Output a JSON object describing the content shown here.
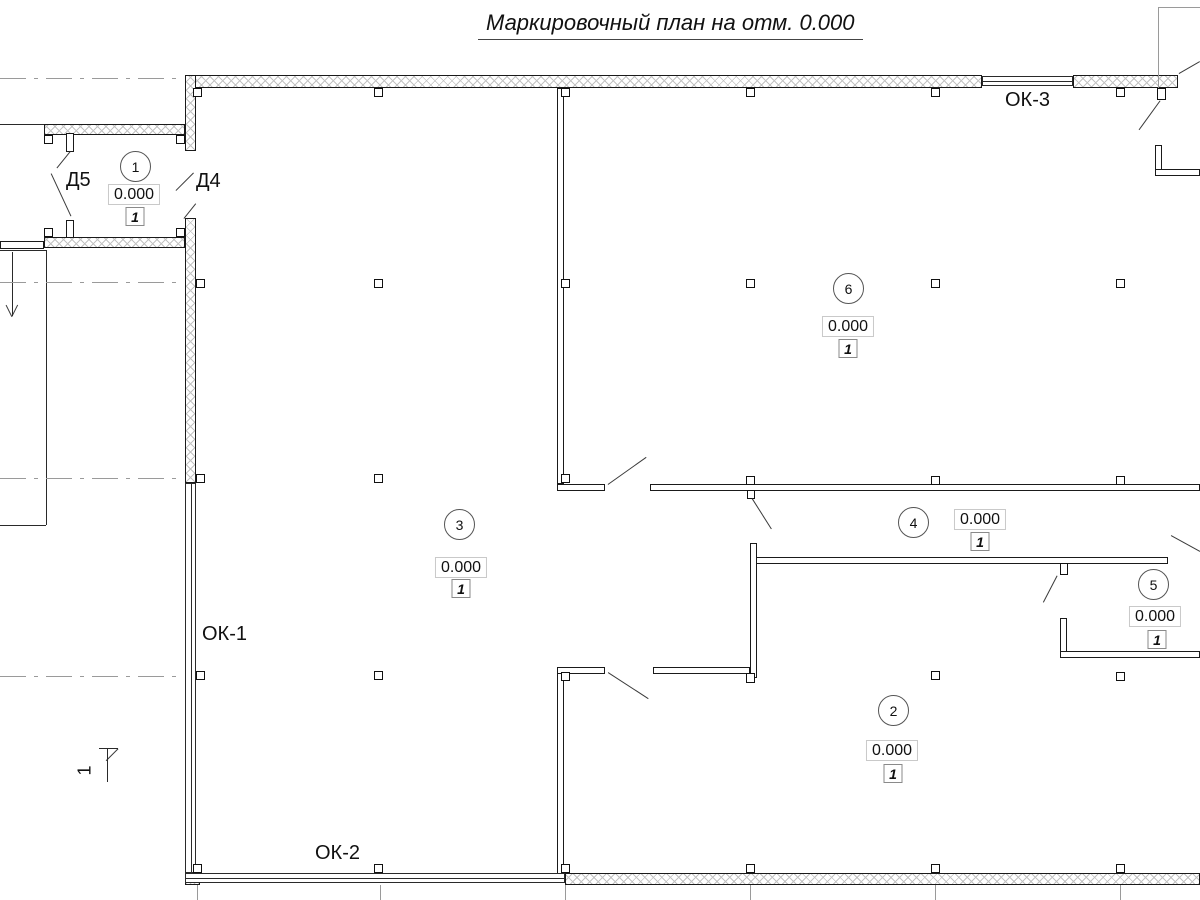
{
  "title": "Маркировочный план на отм. 0.000",
  "labels": {
    "doors": [
      {
        "name": "door-label-d5",
        "text": "Д5",
        "x": 66,
        "y": 169
      },
      {
        "name": "door-label-d4",
        "text": "Д4",
        "x": 196,
        "y": 170
      }
    ],
    "windows": [
      {
        "name": "window-label-ok1",
        "text": "ОК-1",
        "x": 202,
        "y": 623
      },
      {
        "name": "window-label-ok2",
        "text": "ОК-2",
        "x": 315,
        "y": 842
      },
      {
        "name": "window-label-ok3",
        "text": "ОК-3",
        "x": 1005,
        "y": 89
      }
    ],
    "section_mark": {
      "text": "1",
      "x": 80,
      "y": 760
    }
  },
  "rooms": [
    {
      "number": "1",
      "elevation": "0.000",
      "finish": "1",
      "circle": {
        "cx": 135,
        "cy": 166
      },
      "elev_box": {
        "cx": 134,
        "cy": 194
      },
      "finish_box": {
        "cx": 135,
        "cy": 217
      }
    },
    {
      "number": "6",
      "elevation": "0.000",
      "finish": "1",
      "circle": {
        "cx": 848,
        "cy": 288
      },
      "elev_box": {
        "cx": 848,
        "cy": 326
      },
      "finish_box": {
        "cx": 848,
        "cy": 349
      }
    },
    {
      "number": "3",
      "elevation": "0.000",
      "finish": "1",
      "circle": {
        "cx": 459,
        "cy": 524
      },
      "elev_box": {
        "cx": 461,
        "cy": 567
      },
      "finish_box": {
        "cx": 461,
        "cy": 589
      }
    },
    {
      "number": "4",
      "elevation": "0.000",
      "finish": "1",
      "circle": {
        "cx": 913,
        "cy": 522
      },
      "elev_box": {
        "cx": 980,
        "cy": 519
      },
      "finish_box": {
        "cx": 980,
        "cy": 542
      }
    },
    {
      "number": "5",
      "elevation": "0.000",
      "finish": "1",
      "circle": {
        "cx": 1153,
        "cy": 584
      },
      "elev_box": {
        "cx": 1155,
        "cy": 616
      },
      "finish_box": {
        "cx": 1157,
        "cy": 640
      }
    },
    {
      "number": "2",
      "elevation": "0.000",
      "finish": "1",
      "circle": {
        "cx": 893,
        "cy": 710
      },
      "elev_box": {
        "cx": 892,
        "cy": 750
      },
      "finish_box": {
        "cx": 893,
        "cy": 774
      }
    }
  ],
  "geometry": {
    "hatched_walls": [
      {
        "name": "exterior-wall-top-left",
        "x": 185,
        "y": 75,
        "w": 797,
        "h": 13
      },
      {
        "name": "exterior-wall-top-right",
        "x": 1073,
        "y": 75,
        "w": 105,
        "h": 13
      },
      {
        "name": "exterior-wall-left-upper",
        "x": 185,
        "y": 75,
        "w": 11,
        "h": 76
      },
      {
        "name": "exterior-wall-left-mid",
        "x": 185,
        "y": 218,
        "w": 11,
        "h": 265
      },
      {
        "name": "vestibule-wall-top",
        "x": 44,
        "y": 124,
        "w": 141,
        "h": 11
      },
      {
        "name": "vestibule-wall-bottom",
        "x": 44,
        "y": 237,
        "w": 141,
        "h": 11
      },
      {
        "name": "exterior-wall-bottom",
        "x": 565,
        "y": 873,
        "w": 635,
        "h": 12
      },
      {
        "name": "corner-block-bottom-left",
        "x": 185,
        "y": 871,
        "w": 15,
        "h": 14
      }
    ],
    "thin_walls": [
      {
        "name": "interior-wall-a",
        "x": 557,
        "y": 88,
        "w": 7,
        "h": 396
      },
      {
        "name": "interior-wall-a-return",
        "x": 557,
        "y": 484,
        "w": 48,
        "h": 7
      },
      {
        "name": "interior-wall-b",
        "x": 650,
        "y": 484,
        "w": 550,
        "h": 7
      },
      {
        "name": "interior-wall-c",
        "x": 756,
        "y": 557,
        "w": 412,
        "h": 7
      },
      {
        "name": "interior-wall-d",
        "x": 750,
        "y": 543,
        "w": 7,
        "h": 135
      },
      {
        "name": "interior-wall-e",
        "x": 653,
        "y": 667,
        "w": 97,
        "h": 7
      },
      {
        "name": "interior-wall-f",
        "x": 557,
        "y": 667,
        "w": 7,
        "h": 209
      },
      {
        "name": "interior-wall-f-return",
        "x": 557,
        "y": 667,
        "w": 48,
        "h": 7
      },
      {
        "name": "interior-wall-g-vertical",
        "x": 1060,
        "y": 618,
        "w": 7,
        "h": 40
      },
      {
        "name": "interior-wall-g-horizontal",
        "x": 1060,
        "y": 651,
        "w": 140,
        "h": 7
      },
      {
        "name": "interior-wall-h-vertical",
        "x": 1155,
        "y": 145,
        "w": 7,
        "h": 31
      },
      {
        "name": "interior-wall-h-horizontal",
        "x": 1155,
        "y": 169,
        "w": 45,
        "h": 7
      },
      {
        "name": "wall-stub-left-bottom",
        "x": 0,
        "y": 241,
        "w": 44,
        "h": 8
      },
      {
        "name": "door-leaf-d5-upper",
        "x": 66,
        "y": 133,
        "w": 8,
        "h": 19
      },
      {
        "name": "door-leaf-d5-lower",
        "x": 66,
        "y": 220,
        "w": 8,
        "h": 18
      }
    ],
    "windows": [
      {
        "name": "window-ok1",
        "x": 185,
        "y": 483,
        "w": 11,
        "h": 390,
        "dir": "v"
      },
      {
        "name": "window-ok2",
        "x": 185,
        "y": 873,
        "w": 380,
        "h": 10,
        "dir": "h"
      },
      {
        "name": "window-ok3",
        "x": 982,
        "y": 76,
        "w": 91,
        "h": 10,
        "dir": "h"
      }
    ],
    "columns": [
      {
        "x": 193,
        "y": 88
      },
      {
        "x": 374,
        "y": 88
      },
      {
        "x": 561,
        "y": 88
      },
      {
        "x": 746,
        "y": 88
      },
      {
        "x": 931,
        "y": 88
      },
      {
        "x": 1116,
        "y": 88
      },
      {
        "x": 196,
        "y": 279
      },
      {
        "x": 374,
        "y": 279
      },
      {
        "x": 561,
        "y": 279
      },
      {
        "x": 746,
        "y": 279
      },
      {
        "x": 931,
        "y": 279
      },
      {
        "x": 1116,
        "y": 279
      },
      {
        "x": 196,
        "y": 474
      },
      {
        "x": 374,
        "y": 474
      },
      {
        "x": 561,
        "y": 474
      },
      {
        "x": 746,
        "y": 476
      },
      {
        "x": 931,
        "y": 476
      },
      {
        "x": 1116,
        "y": 476
      },
      {
        "x": 196,
        "y": 671
      },
      {
        "x": 374,
        "y": 671
      },
      {
        "x": 561,
        "y": 672
      },
      {
        "x": 931,
        "y": 671
      },
      {
        "x": 1116,
        "y": 672
      },
      {
        "x": 193,
        "y": 864
      },
      {
        "x": 374,
        "y": 864
      },
      {
        "x": 561,
        "y": 864
      },
      {
        "x": 746,
        "y": 864
      },
      {
        "x": 931,
        "y": 864
      },
      {
        "x": 1116,
        "y": 864
      },
      {
        "x": 44,
        "y": 135
      },
      {
        "x": 176,
        "y": 135
      },
      {
        "x": 44,
        "y": 228
      },
      {
        "x": 176,
        "y": 228
      },
      {
        "x": 747,
        "y": 490,
        "w": 8,
        "h": 9
      },
      {
        "x": 1060,
        "y": 563,
        "w": 8,
        "h": 12
      },
      {
        "x": 746,
        "y": 673,
        "w": 9,
        "h": 10
      },
      {
        "x": 1157,
        "y": 88,
        "w": 9,
        "h": 12
      }
    ],
    "diagonals": [
      {
        "name": "door-d5-leader",
        "x1": 70,
        "y1": 152,
        "x2": 57,
        "y2": 168
      },
      {
        "name": "door-d5-swing",
        "x1": 51,
        "y1": 174,
        "x2": 71,
        "y2": 217
      },
      {
        "name": "door-d4-swing-upper",
        "x1": 176,
        "y1": 191,
        "x2": 194,
        "y2": 173
      },
      {
        "name": "door-d4-swing-lower",
        "x1": 184,
        "y1": 219,
        "x2": 196,
        "y2": 204
      },
      {
        "name": "door-swing-mid-upper",
        "x1": 608,
        "y1": 485,
        "x2": 646,
        "y2": 458
      },
      {
        "name": "leader-room4-column",
        "x1": 752,
        "y1": 499,
        "x2": 771,
        "y2": 529
      },
      {
        "name": "leader-wall-c-column",
        "x1": 1057,
        "y1": 576,
        "x2": 1043,
        "y2": 603
      },
      {
        "name": "door-swing-mid-lower",
        "x1": 608,
        "y1": 673,
        "x2": 648,
        "y2": 699
      },
      {
        "name": "leader-top-right-column",
        "x1": 1160,
        "y1": 101,
        "x2": 1139,
        "y2": 130
      },
      {
        "name": "leader-top-right-corner",
        "x1": 1179,
        "y1": 74,
        "x2": 1200,
        "y2": 62
      },
      {
        "name": "leader-right-edge",
        "x1": 1171,
        "y1": 536,
        "x2": 1200,
        "y2": 552
      },
      {
        "name": "entry-arrow-head-left",
        "x1": 12,
        "y1": 317,
        "x2": 6,
        "y2": 305
      },
      {
        "name": "entry-arrow-head-right",
        "x1": 12,
        "y1": 317,
        "x2": 18,
        "y2": 305
      },
      {
        "name": "section-arrow-barb",
        "x1": 118,
        "y1": 749,
        "x2": 106,
        "y2": 761
      }
    ],
    "solid_lines": [
      {
        "name": "wall-edge-top-left",
        "x": 0,
        "y": 124,
        "len": 44,
        "dir": "h"
      },
      {
        "name": "entry-line-top",
        "x": 0,
        "y": 250,
        "len": 46,
        "dir": "h"
      },
      {
        "name": "entry-line-side",
        "x": 46,
        "y": 250,
        "len": 275,
        "dir": "v"
      },
      {
        "name": "entry-line-bottom",
        "x": 0,
        "y": 525,
        "len": 46,
        "dir": "h"
      },
      {
        "name": "entry-arrow-shaft",
        "x": 12,
        "y": 252,
        "len": 64,
        "dir": "v"
      },
      {
        "name": "section-arrow-crossbar",
        "x": 99,
        "y": 748,
        "len": 19,
        "dir": "h"
      },
      {
        "name": "section-arrow-shaft",
        "x": 107,
        "y": 748,
        "len": 34,
        "dir": "v"
      }
    ],
    "dashed_axes": [
      {
        "name": "axis-row-1",
        "x": 0,
        "y": 78,
        "len": 183
      },
      {
        "name": "axis-row-2",
        "x": 0,
        "y": 282,
        "len": 183
      },
      {
        "name": "axis-row-3",
        "x": 0,
        "y": 478,
        "len": 183
      },
      {
        "name": "axis-row-4",
        "x": 0,
        "y": 676,
        "len": 183
      }
    ],
    "grid_lines": [
      {
        "name": "grid-v1",
        "x": 197,
        "y": 885,
        "len": 15,
        "dir": "v"
      },
      {
        "name": "grid-v2",
        "x": 380,
        "y": 885,
        "len": 15,
        "dir": "v"
      },
      {
        "name": "grid-v3",
        "x": 565,
        "y": 885,
        "len": 15,
        "dir": "v"
      },
      {
        "name": "grid-v4",
        "x": 750,
        "y": 885,
        "len": 15,
        "dir": "v"
      },
      {
        "name": "grid-v5",
        "x": 935,
        "y": 885,
        "len": 15,
        "dir": "v"
      },
      {
        "name": "grid-v6",
        "x": 1120,
        "y": 885,
        "len": 15,
        "dir": "v"
      },
      {
        "name": "grid-top-right-v",
        "x": 1158,
        "y": 7,
        "len": 81,
        "dir": "v"
      },
      {
        "name": "grid-top-right-h",
        "x": 1158,
        "y": 7,
        "len": 42,
        "dir": "h"
      }
    ]
  }
}
